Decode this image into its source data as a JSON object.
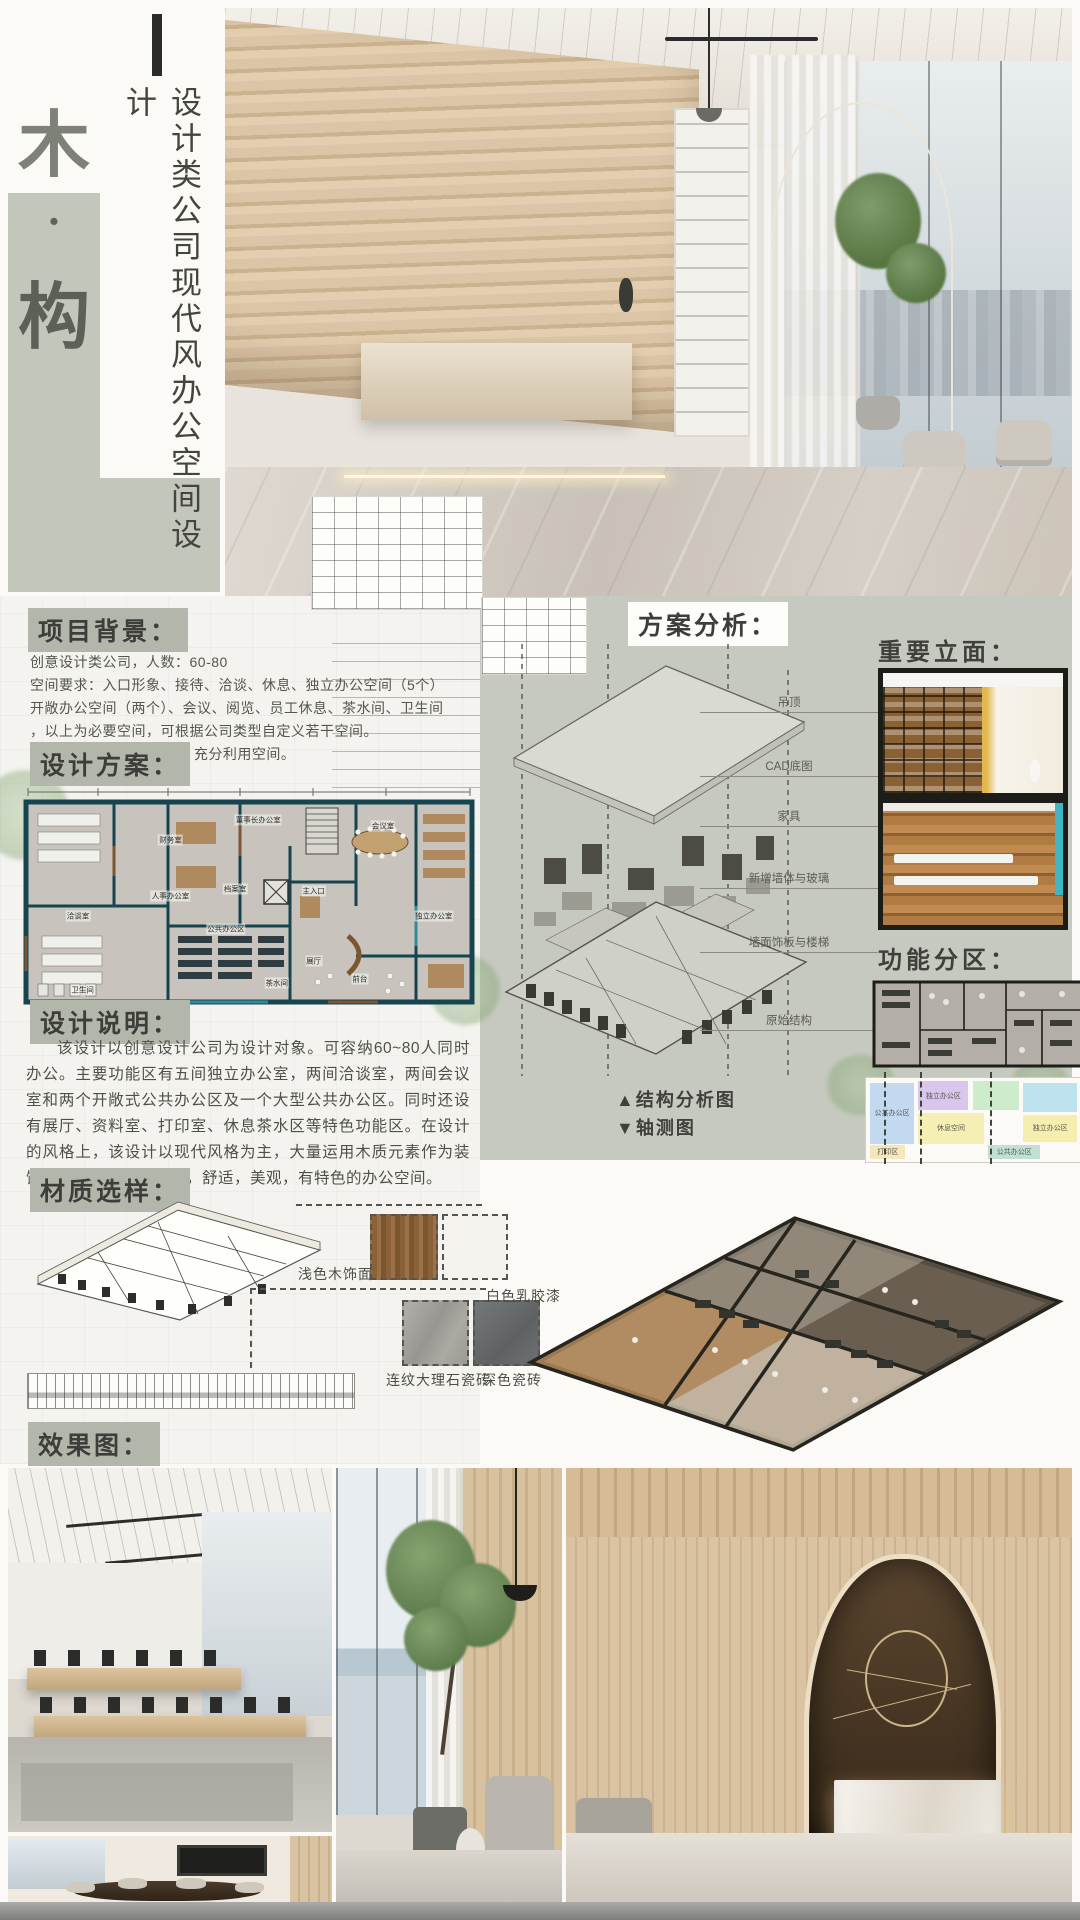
{
  "poster": {
    "title_char_top": "木",
    "title_dot": "·",
    "title_char_bottom": "构",
    "subtitle": "设计类公司现代风办公空间设计"
  },
  "colors": {
    "sage": "#c6c9bf",
    "sage_dark": "#b3b7ab",
    "ink": "#3f403c",
    "plan_wall_teal": "#16444f",
    "accent_cyan": "#41b5c5",
    "wood": "#8a6134"
  },
  "sections": {
    "background": {
      "heading": "项目背景：",
      "lines": [
        "创意设计类公司，人数：60-80",
        "空间要求：入口形象、接待、洽谈、休息、独立办公空间（5个）",
        "开敞办公空间（两个）、会议、阅览、员工休息、茶水间、卫生间",
        "，以上为必要空间，可根据公司类型自定义若干空间。",
        "整体基本要求：布局合理 充分利用空间。"
      ]
    },
    "plan": {
      "heading": "设计方案：",
      "rooms": [
        "财务室",
        "人事办公室",
        "董事长办公室",
        "档案室",
        "主入口",
        "会议室",
        "洽谈室",
        "卫生间",
        "公共办公区",
        "茶水间",
        "展厅",
        "前台",
        "独立办公室"
      ]
    },
    "description": {
      "heading": "设计说明：",
      "text": "该设计以创意设计公司为设计对象。可容纳60~80人同时办公。主要功能区有五间独立办公室，两间洽谈室，两间会议室和两个开敞式公共办公区及一个大型公共办公区。同时还设有展厅、资料室、打印室、休息茶水区等特色功能区。在设计的风格上，该设计以现代风格为主，大量运用木质元素作为装饰。力图打造一个高效，舒适，美观，有特色的办公空间。"
    },
    "materials": {
      "heading": "材质选样：",
      "items": [
        "浅色木饰面",
        "白色乳胶漆",
        "连纹大理石瓷砖",
        "深色瓷砖"
      ]
    },
    "renders": {
      "heading": "效果图："
    },
    "analysis": {
      "heading": "方案分析：",
      "axon_labels": [
        "吊顶",
        "CAD底图",
        "家具",
        "新增墙体与玻璃",
        "墙面饰板与楼梯",
        "原始结构"
      ],
      "caption_structure": "▲结构分析图",
      "caption_axon": "▼轴测图"
    },
    "elevations": {
      "heading": "重要立面："
    },
    "zoning": {
      "heading": "功能分区：",
      "zones": [
        "公共办公区",
        "独立办公区",
        "休息空间",
        "打印区",
        "公共办公区",
        "独立办公区"
      ]
    }
  }
}
